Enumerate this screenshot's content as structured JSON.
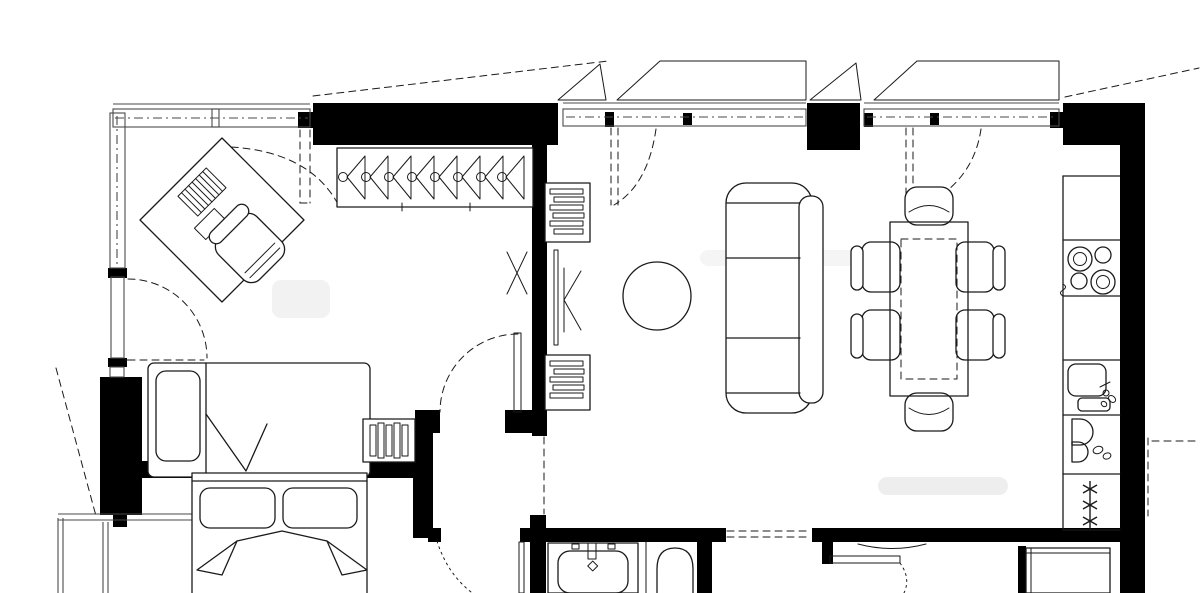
{
  "drawing": {
    "kind": "apartment-floor-plan",
    "colors": {
      "background": "#ffffff",
      "line": "#1a1a1a",
      "wall": "#000000",
      "window_line": "#4a4a4a",
      "watermark": "#ececec"
    },
    "rooms": [
      {
        "name": "bedroom-study",
        "furniture": [
          "rotated-desk",
          "desk-chair",
          "single-bed",
          "pillow",
          "radiator-nightstand",
          "balcony-door",
          "windows"
        ]
      },
      {
        "name": "walk-in-closet-hall",
        "furniture": [
          "wardrobe-with-hangers",
          "shelving-unit-top",
          "shelving-unit-bottom",
          "chair-symbol",
          "interior-door"
        ]
      },
      {
        "name": "living-dining-room",
        "furniture": [
          "three-seat-sofa",
          "round-side-table",
          "dining-table",
          "dining-chairs",
          "tilt-windows"
        ]
      },
      {
        "name": "kitchen",
        "furniture": [
          "counter-run",
          "cooktop-four-burner",
          "kitchen-sink",
          "wash-unit",
          "freezer"
        ]
      },
      {
        "name": "second-bedroom",
        "furniture": [
          "double-bed",
          "pillows",
          "bay-window"
        ]
      },
      {
        "name": "bathroom",
        "furniture": [
          "washbasin",
          "bathtub-arch"
        ]
      },
      {
        "name": "hall-closet",
        "furniture": []
      }
    ],
    "counts": {
      "hangers": 8,
      "cooktop_burners": 4,
      "freezer_snowflakes": 3,
      "dining_chairs": 6,
      "sofa_cushions": 3,
      "double_bed_pillows": 2
    }
  }
}
